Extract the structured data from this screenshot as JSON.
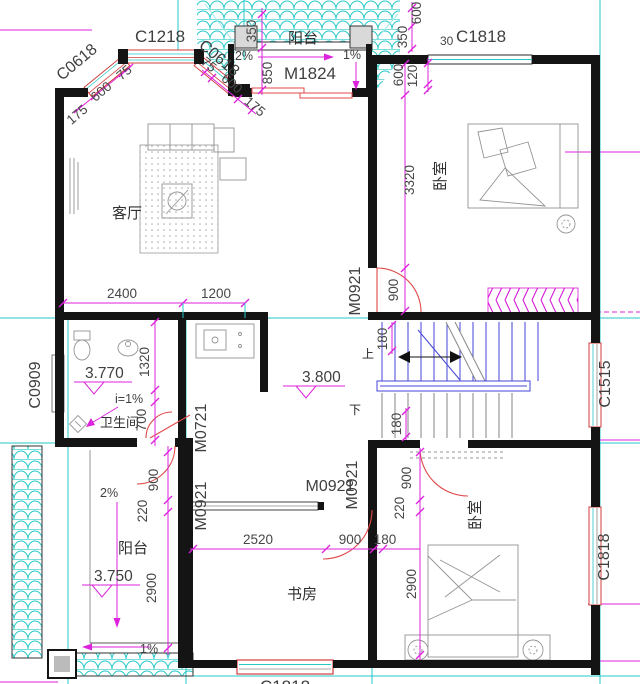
{
  "drawing_type": "floor-plan",
  "colors": {
    "wall": "#141414",
    "grid_teal": "#25c7c7",
    "dimension_magenta": "#dd22dd",
    "opening_red": "#e04848",
    "stair_blue": "#4646d8"
  },
  "rooms": {
    "living": "客厅",
    "bedroom_top": "卧室",
    "bedroom_bottom": "卧室",
    "bathroom": "卫生间",
    "study": "书房",
    "balcony_top": "阳台",
    "balcony_bottom": "阳台"
  },
  "windows": {
    "c0618_left": "C0618",
    "c1218": "C1218",
    "c0618_right": "C0618",
    "c1818_top": "C1818",
    "c0909": "C0909",
    "c1515": "C1515",
    "c1818_right": "C1818",
    "bottom_partial": "C1818"
  },
  "doors": {
    "m1824": "M1824",
    "m0921_bedroom_top": "M0921",
    "m0721_bath": "M0721",
    "m0921_balcony": "M0921",
    "m0921_hall": "M0921",
    "m0921_bedroom_bottom": "M0921"
  },
  "levels": {
    "bath": "3.770",
    "hall": "3.800",
    "balcony": "3.750"
  },
  "slopes": {
    "balcony_top_left": "2%",
    "balcony_top_right": "1%",
    "bath": "i=1%",
    "balcony_bottom_down": "2%",
    "balcony_bottom_left": "1%"
  },
  "stair": {
    "up": "上",
    "down": "下"
  },
  "dims": {
    "bay_175_l": "175",
    "bay_600_l": "600",
    "bay_75_l": "75",
    "bay_75_r": "75",
    "bay_600_r": "600",
    "bay_175_r": "175",
    "balcony_350": "350",
    "balcony_850": "850",
    "tr_600_top": "600",
    "tr_350": "350",
    "tr_600_inner": "600",
    "tr_120": "120",
    "tr_30": "30",
    "living_2400": "2400",
    "living_1200": "1200",
    "bed1_3320": "3320",
    "bed1_900": "900",
    "stair_180_top": "180",
    "stair_180_bottom": "180",
    "bath_1320": "1320",
    "bath_700": "700",
    "balc_900": "900",
    "balc_220": "220",
    "balc_2900": "2900",
    "study_2520": "2520",
    "study_900": "900",
    "study_180": "180",
    "bed2_900": "900",
    "bed2_220": "220",
    "bed2_2900": "2900"
  }
}
